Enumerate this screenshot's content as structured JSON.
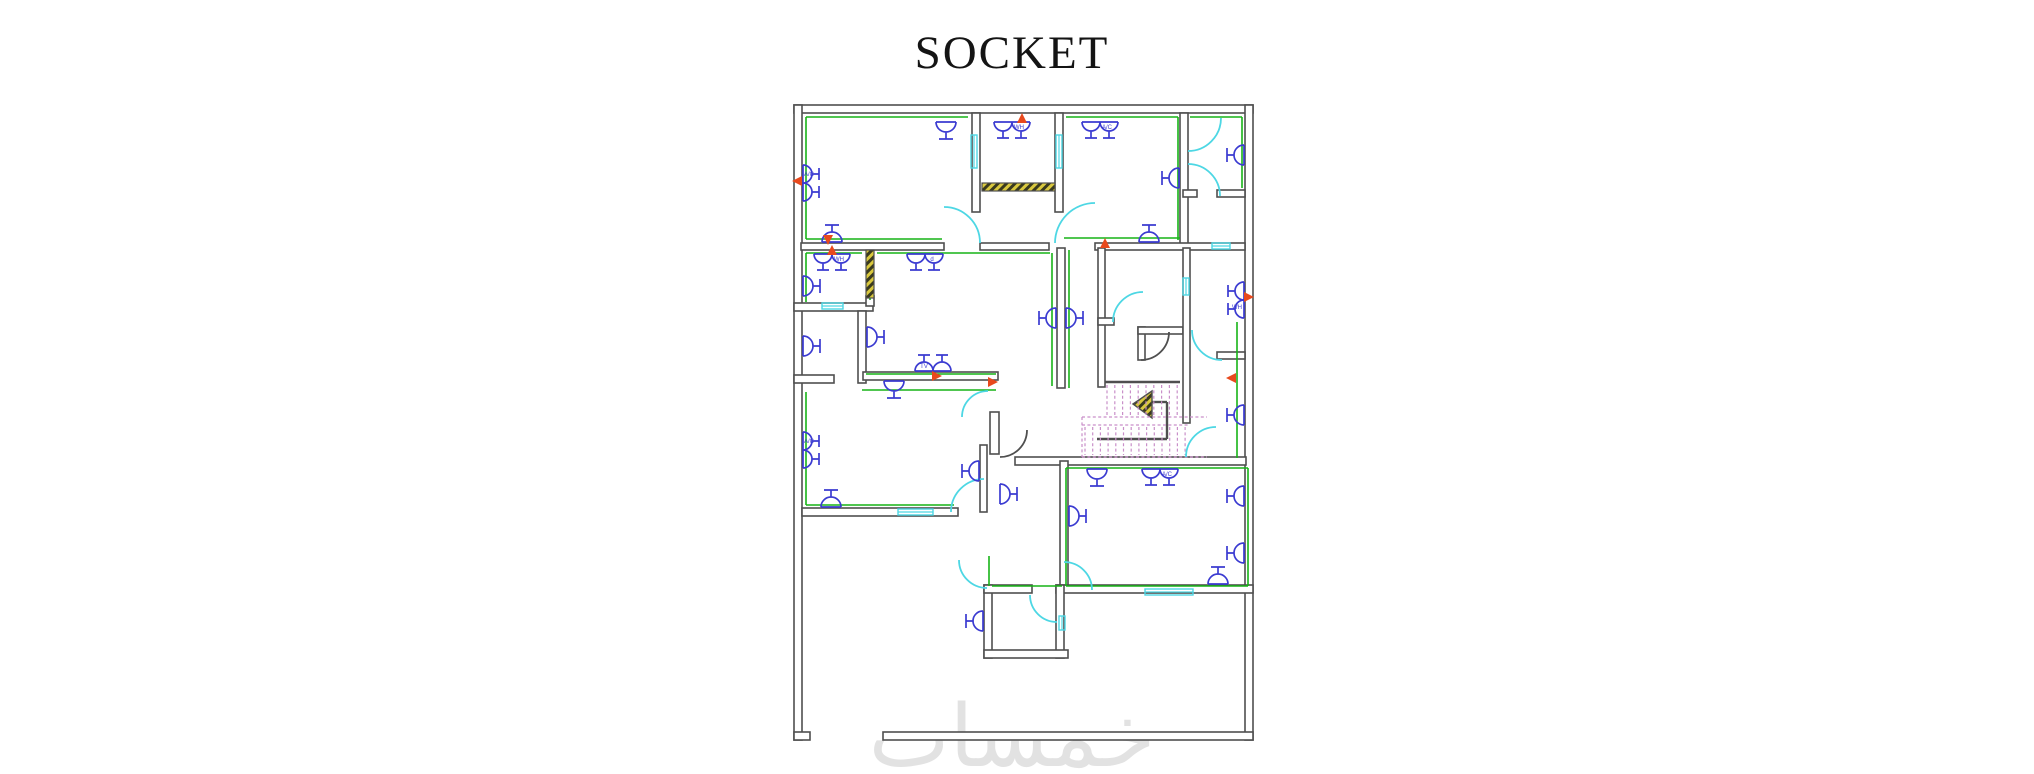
{
  "title": {
    "text": "SOCKET"
  },
  "watermark": {
    "text": "خمسات"
  },
  "colors": {
    "wall": "#4f4f4f",
    "wall_fill": "#ffffff",
    "wiring": "#17b417",
    "door": "#4dd7e4",
    "door_dark": "#4f4f4f",
    "socket": "#3b3bd1",
    "marker": "#e8491d",
    "hatch_yellow": "#d9c83e",
    "hatch_stripe": "#3a3a1e",
    "stairs": "#c98fc9",
    "watermark_gray": "#e2e2e2",
    "title_color": "#141414"
  },
  "plan": {
    "walls": [
      [
        794,
        105,
        459,
        8
      ],
      [
        794,
        105,
        8,
        635
      ],
      [
        1245,
        105,
        8,
        635
      ],
      [
        883,
        732,
        370,
        8
      ],
      [
        794,
        732,
        16,
        8
      ],
      [
        972,
        113,
        8,
        99
      ],
      [
        1055,
        113,
        8,
        99
      ],
      [
        1180,
        113,
        8,
        134
      ],
      [
        801,
        243,
        143,
        7
      ],
      [
        980,
        243,
        69,
        7
      ],
      [
        1095,
        243,
        150,
        7
      ],
      [
        1183,
        190,
        14,
        7
      ],
      [
        1217,
        190,
        28,
        7
      ],
      [
        794,
        303,
        79,
        8
      ],
      [
        858,
        311,
        8,
        72
      ],
      [
        794,
        375,
        40,
        8
      ],
      [
        863,
        372,
        135,
        8
      ],
      [
        802,
        508,
        156,
        8
      ],
      [
        980,
        445,
        7,
        67
      ],
      [
        1057,
        248,
        8,
        140
      ],
      [
        990,
        412,
        9,
        42
      ],
      [
        1015,
        457,
        231,
        8
      ],
      [
        1098,
        248,
        7,
        139
      ],
      [
        1098,
        318,
        16,
        7
      ],
      [
        1138,
        327,
        7,
        33
      ],
      [
        1138,
        327,
        45,
        7
      ],
      [
        1183,
        248,
        7,
        175
      ],
      [
        1217,
        352,
        28,
        7
      ],
      [
        1060,
        461,
        8,
        131
      ],
      [
        1056,
        585,
        197,
        8
      ],
      [
        984,
        585,
        8,
        73
      ],
      [
        1056,
        585,
        8,
        73
      ],
      [
        984,
        650,
        84,
        8
      ],
      [
        984,
        585,
        48,
        8
      ],
      [
        866,
        296,
        8,
        10
      ]
    ],
    "stair_outline": [
      [
        1105,
        382,
        1180,
        382
      ],
      [
        1152,
        402,
        1167,
        402
      ],
      [
        1167,
        402,
        1167,
        439
      ],
      [
        1097,
        439,
        1167,
        439
      ]
    ],
    "green_lines": [
      [
        806,
        117,
        968,
        117
      ],
      [
        806,
        117,
        806,
        239
      ],
      [
        806,
        239,
        942,
        239
      ],
      [
        1064,
        238,
        1180,
        238
      ],
      [
        1066,
        117,
        1178,
        117
      ],
      [
        1178,
        117,
        1178,
        240
      ],
      [
        1190,
        117,
        1242,
        117
      ],
      [
        1242,
        117,
        1242,
        188
      ],
      [
        806,
        253,
        862,
        253
      ],
      [
        806,
        253,
        806,
        302
      ],
      [
        870,
        253,
        870,
        300
      ],
      [
        877,
        253,
        1050,
        253
      ],
      [
        1052,
        253,
        1052,
        386
      ],
      [
        1069,
        250,
        1069,
        388
      ],
      [
        866,
        374,
        996,
        374
      ],
      [
        862,
        390,
        996,
        390
      ],
      [
        806,
        392,
        806,
        505
      ],
      [
        806,
        505,
        954,
        505
      ],
      [
        1066,
        468,
        1248,
        468
      ],
      [
        1248,
        468,
        1248,
        586
      ],
      [
        1066,
        468,
        1066,
        586
      ],
      [
        1066,
        586,
        1248,
        586
      ],
      [
        1237,
        322,
        1237,
        458
      ],
      [
        989,
        556,
        989,
        586
      ],
      [
        992,
        586,
        1062,
        586
      ]
    ],
    "hatch_bars": [
      [
        982,
        183,
        73,
        8
      ],
      [
        866,
        250,
        8,
        48
      ]
    ],
    "stair_arrow": [
      [
        1133,
        404
      ],
      [
        1152,
        391
      ],
      [
        1152,
        418
      ]
    ],
    "doors": [
      {
        "c": [
          944,
          243
        ],
        "r": 36,
        "a1": 270,
        "a2": 360,
        "dark": false
      },
      {
        "c": [
          1095,
          243
        ],
        "r": 40,
        "a1": 180,
        "a2": 270,
        "dark": false
      },
      {
        "c": [
          1188,
          118
        ],
        "r": 33,
        "a1": 0,
        "a2": 90,
        "dark": false
      },
      {
        "c": [
          1188,
          196
        ],
        "r": 32,
        "a1": 270,
        "a2": 360,
        "dark": false
      },
      {
        "c": [
          1143,
          322
        ],
        "r": 30,
        "a1": 180,
        "a2": 270,
        "dark": false
      },
      {
        "c": [
          1141,
          332
        ],
        "r": 28,
        "a1": 0,
        "a2": 90,
        "dark": true
      },
      {
        "c": [
          1222,
          330
        ],
        "r": 30,
        "a1": 90,
        "a2": 180,
        "dark": false
      },
      {
        "c": [
          1216,
          457
        ],
        "r": 30,
        "a1": 180,
        "a2": 270,
        "dark": false
      },
      {
        "c": [
          987,
          560
        ],
        "r": 28,
        "a1": 90,
        "a2": 180,
        "dark": false
      },
      {
        "c": [
          1064,
          590
        ],
        "r": 28,
        "a1": 270,
        "a2": 360,
        "dark": false
      },
      {
        "c": [
          1057,
          595
        ],
        "r": 27,
        "a1": 90,
        "a2": 180,
        "dark": false
      },
      {
        "c": [
          1000,
          430
        ],
        "r": 27,
        "a1": 0,
        "a2": 90,
        "dark": true
      },
      {
        "c": [
          984,
          512
        ],
        "r": 33,
        "a1": 180,
        "a2": 270,
        "dark": false
      },
      {
        "c": [
          988,
          417
        ],
        "r": 26,
        "a1": 180,
        "a2": 270,
        "dark": false
      }
    ],
    "windows": [
      {
        "p": [
          822,
          306,
          843,
          306
        ]
      },
      {
        "p": [
          898,
          512,
          933,
          512
        ]
      },
      {
        "p": [
          1145,
          592,
          1193,
          592
        ]
      },
      {
        "p": [
          974,
          135,
          974,
          168
        ]
      },
      {
        "p": [
          1059,
          135,
          1059,
          168
        ]
      },
      {
        "p": [
          1212,
          246,
          1230,
          246
        ]
      },
      {
        "p": [
          1186,
          278,
          1186,
          295
        ]
      },
      {
        "p": [
          1062,
          616,
          1062,
          630
        ]
      }
    ],
    "sockets": [
      {
        "x": 946,
        "y": 121,
        "d": "N",
        "n": 1,
        "label": ""
      },
      {
        "x": 802,
        "y": 183,
        "d": "W",
        "n": 2,
        "label": "A/C"
      },
      {
        "x": 832,
        "y": 243,
        "d": "S",
        "n": 1,
        "label": ""
      },
      {
        "x": 1012,
        "y": 121,
        "d": "N",
        "n": 2,
        "label": "WH"
      },
      {
        "x": 1100,
        "y": 121,
        "d": "N",
        "n": 2,
        "label": "A/C"
      },
      {
        "x": 1180,
        "y": 178,
        "d": "E",
        "n": 1,
        "label": ""
      },
      {
        "x": 1245,
        "y": 155,
        "d": "E",
        "n": 1,
        "label": ""
      },
      {
        "x": 1149,
        "y": 243,
        "d": "S",
        "n": 1,
        "label": ""
      },
      {
        "x": 832,
        "y": 253,
        "d": "N",
        "n": 2,
        "label": "WH"
      },
      {
        "x": 802,
        "y": 286,
        "d": "W",
        "n": 1,
        "label": ""
      },
      {
        "x": 925,
        "y": 253,
        "d": "N",
        "n": 2,
        "label": "d"
      },
      {
        "x": 802,
        "y": 346,
        "d": "W",
        "n": 1,
        "label": ""
      },
      {
        "x": 866,
        "y": 337,
        "d": "W",
        "n": 1,
        "label": ""
      },
      {
        "x": 933,
        "y": 372,
        "d": "S",
        "n": 2,
        "label": "TV"
      },
      {
        "x": 894,
        "y": 380,
        "d": "N",
        "n": 1,
        "label": ""
      },
      {
        "x": 1057,
        "y": 318,
        "d": "E",
        "n": 1,
        "label": ""
      },
      {
        "x": 1065,
        "y": 318,
        "d": "W",
        "n": 1,
        "label": ""
      },
      {
        "x": 802,
        "y": 450,
        "d": "W",
        "n": 2,
        "label": "A/C"
      },
      {
        "x": 831,
        "y": 508,
        "d": "S",
        "n": 1,
        "label": ""
      },
      {
        "x": 980,
        "y": 471,
        "d": "E",
        "n": 1,
        "label": ""
      },
      {
        "x": 999,
        "y": 494,
        "d": "W",
        "n": 1,
        "label": ""
      },
      {
        "x": 984,
        "y": 621,
        "d": "E",
        "n": 1,
        "label": ""
      },
      {
        "x": 1097,
        "y": 468,
        "d": "N",
        "n": 1,
        "label": ""
      },
      {
        "x": 1160,
        "y": 468,
        "d": "N",
        "n": 2,
        "label": "A/C"
      },
      {
        "x": 1068,
        "y": 516,
        "d": "W",
        "n": 1,
        "label": ""
      },
      {
        "x": 1245,
        "y": 496,
        "d": "E",
        "n": 1,
        "label": ""
      },
      {
        "x": 1245,
        "y": 553,
        "d": "E",
        "n": 1,
        "label": ""
      },
      {
        "x": 1218,
        "y": 585,
        "d": "S",
        "n": 1,
        "label": ""
      },
      {
        "x": 1245,
        "y": 300,
        "d": "E",
        "n": 2,
        "label": "WH"
      },
      {
        "x": 1245,
        "y": 415,
        "d": "E",
        "n": 1,
        "label": ""
      }
    ],
    "markers": [
      {
        "x": 1022,
        "y": 118,
        "d": "up"
      },
      {
        "x": 797,
        "y": 181,
        "d": "left"
      },
      {
        "x": 828,
        "y": 240,
        "d": "down"
      },
      {
        "x": 832,
        "y": 250,
        "d": "up"
      },
      {
        "x": 1105,
        "y": 243,
        "d": "up"
      },
      {
        "x": 937,
        "y": 376,
        "d": "right"
      },
      {
        "x": 993,
        "y": 382,
        "d": "right"
      },
      {
        "x": 1249,
        "y": 297,
        "d": "right"
      },
      {
        "x": 1231,
        "y": 378,
        "d": "left"
      }
    ],
    "stairs": {
      "upper_treads": {
        "x0": 1107,
        "count": 10,
        "dx": 7.8,
        "y1": 385,
        "y2": 415
      },
      "lower_treads": {
        "x0": 1085,
        "count": 14,
        "dx": 7.7,
        "y1": 427,
        "y2": 455
      },
      "guides": [
        [
          1082,
          417,
          1207,
          417
        ],
        [
          1082,
          425,
          1188,
          425
        ],
        [
          1082,
          457,
          1207,
          457
        ],
        [
          1082,
          417,
          1082,
          457
        ]
      ]
    }
  }
}
